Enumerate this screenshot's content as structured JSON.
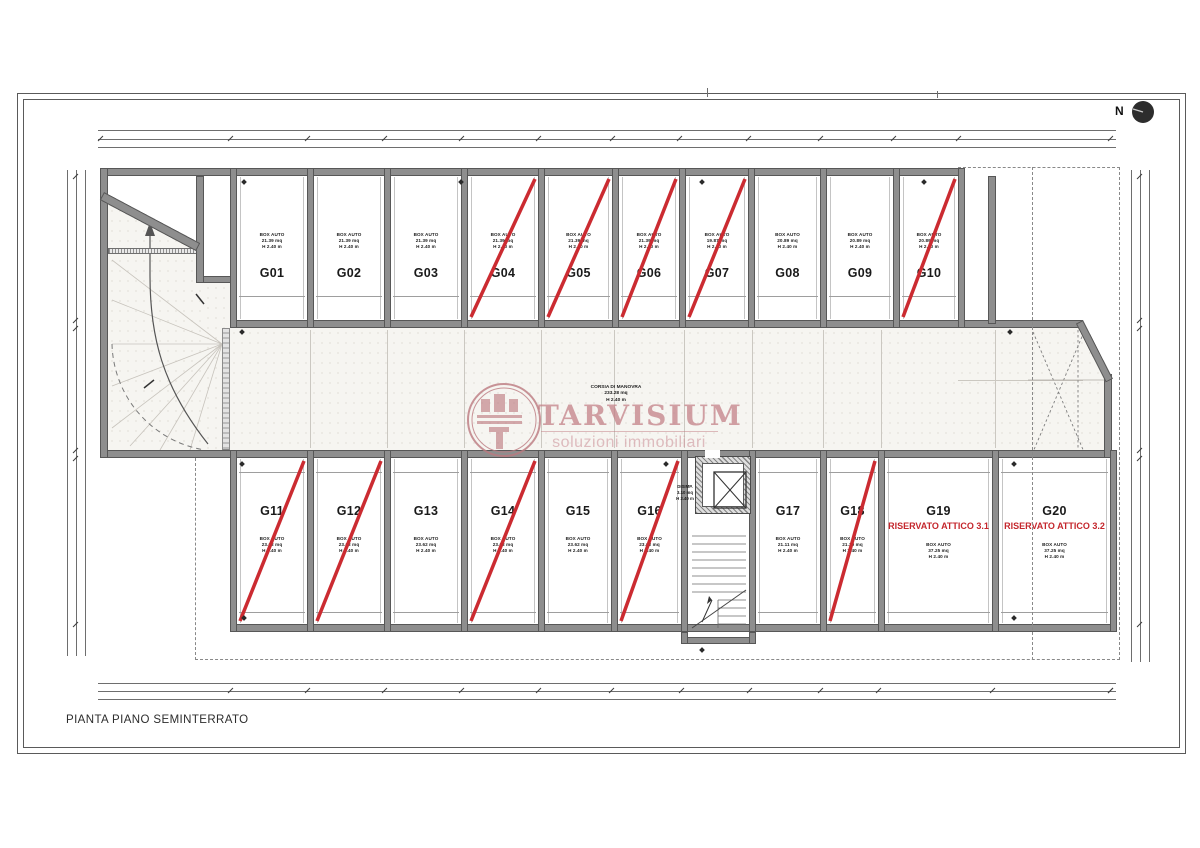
{
  "page": {
    "title": "PIANTA PIANO SEMINTERRATO",
    "compass_label": "N"
  },
  "watermark": {
    "brand": "TARVISIUM",
    "tagline": "soluzioni immobiliari"
  },
  "corridor": {
    "label": "CORSIA DI MANOVRA",
    "area": "233.28 mq",
    "height": "H 2.40 m"
  },
  "hallway": {
    "label": "DISIMP.",
    "area": "3.10 mq",
    "height": "H 2.40 m"
  },
  "colors": {
    "wall": "#8e8e8e",
    "sold_line": "#cb2b31",
    "reserved_text": "#c4262c",
    "watermark_pink": "#c18089"
  },
  "garages": {
    "top_row": [
      {
        "id": "G01",
        "type": "BOX AUTO",
        "area": "21.39 mq",
        "height": "H 2.40 m",
        "marked": false
      },
      {
        "id": "G02",
        "type": "BOX AUTO",
        "area": "21.39 mq",
        "height": "H 2.40 m",
        "marked": false
      },
      {
        "id": "G03",
        "type": "BOX AUTO",
        "area": "21.39 mq",
        "height": "H 2.40 m",
        "marked": false
      },
      {
        "id": "G04",
        "type": "BOX AUTO",
        "area": "21.39 mq",
        "height": "H 2.40 m",
        "marked": true
      },
      {
        "id": "G05",
        "type": "BOX AUTO",
        "area": "21.39 mq",
        "height": "H 2.40 m",
        "marked": true
      },
      {
        "id": "G06",
        "type": "BOX AUTO",
        "area": "21.39 mq",
        "height": "H 2.40 m",
        "marked": true
      },
      {
        "id": "G07",
        "type": "BOX AUTO",
        "area": "19.87 mq",
        "height": "H 2.40 m",
        "marked": true
      },
      {
        "id": "G08",
        "type": "BOX AUTO",
        "area": "20.89 mq",
        "height": "H 2.40 m",
        "marked": false
      },
      {
        "id": "G09",
        "type": "BOX AUTO",
        "area": "20.89 mq",
        "height": "H 2.40 m",
        "marked": false
      },
      {
        "id": "G10",
        "type": "BOX AUTO",
        "area": "20.89 mq",
        "height": "H 2.40 m",
        "marked": true
      }
    ],
    "bottom_row": [
      {
        "id": "G11",
        "type": "BOX AUTO",
        "area": "23.62 mq",
        "height": "H 2.40 m",
        "marked": true
      },
      {
        "id": "G12",
        "type": "BOX AUTO",
        "area": "23.62 mq",
        "height": "H 2.40 m",
        "marked": true
      },
      {
        "id": "G13",
        "type": "BOX AUTO",
        "area": "23.62 mq",
        "height": "H 2.40 m",
        "marked": false
      },
      {
        "id": "G14",
        "type": "BOX AUTO",
        "area": "23.62 mq",
        "height": "H 2.40 m",
        "marked": true
      },
      {
        "id": "G15",
        "type": "BOX AUTO",
        "area": "23.62 mq",
        "height": "H 2.40 m",
        "marked": false
      },
      {
        "id": "G16",
        "type": "BOX AUTO",
        "area": "23.62 mq",
        "height": "H 2.40 m",
        "marked": true
      },
      {
        "id": "G17",
        "type": "BOX AUTO",
        "area": "21.11 mq",
        "height": "H 2.40 m",
        "marked": false
      },
      {
        "id": "G18",
        "type": "BOX AUTO",
        "area": "21.30 mq",
        "height": "H 2.40 m",
        "marked": true
      },
      {
        "id": "G19",
        "type": "BOX AUTO",
        "area": "37.25 mq",
        "height": "H 2.40 m",
        "marked": false,
        "reserved": "RISERVATO ATTICO 3.1"
      },
      {
        "id": "G20",
        "type": "BOX AUTO",
        "area": "37.25 mq",
        "height": "H 2.40 m",
        "marked": false,
        "reserved": "RISERVATO ATTICO 3.2"
      }
    ]
  }
}
